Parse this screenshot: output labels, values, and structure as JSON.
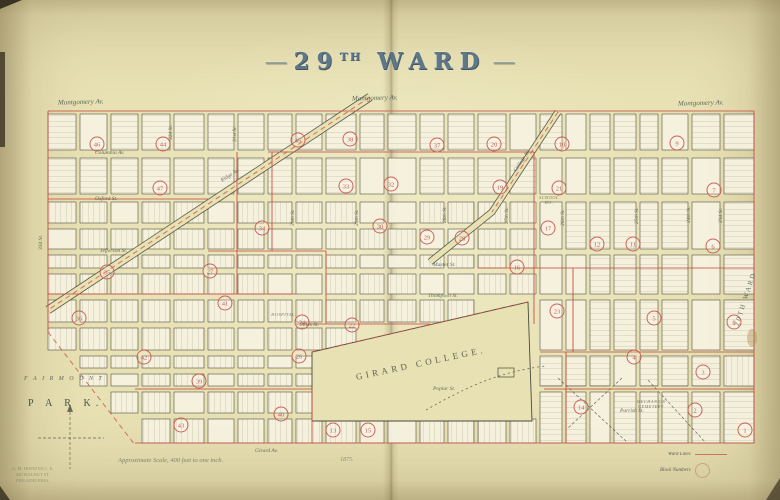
{
  "page": {
    "title_num": "29",
    "title_sup": "TH",
    "title_word": "WARD",
    "dash": "—"
  },
  "labels": {
    "montgomery": "Montgomery Av.",
    "fairmount": "F A I R M O U N T",
    "park": "P A R K.",
    "girard_college": "GIRARD  COLLEGE.",
    "side_ward": "20TH WARD",
    "scale_note": "Approximate Scale, 400 feet to one inch.",
    "date_note": "1875.",
    "legend_ward": "Ward Lines",
    "legend_block": "Block Numbers",
    "stamp": [
      "G. M. HOPKINS  C. E.",
      "320 WALNUT ST.",
      "PHILADELPHIA."
    ]
  },
  "colors": {
    "paper": "#e8e1b4",
    "block": "#f6f2df",
    "ink": "#4a4a3c",
    "red": "#c9544c",
    "faint_ink": "#80806c"
  },
  "map": {
    "bounds": {
      "x0": 48,
      "y0": 111,
      "x1": 754,
      "y1": 443
    },
    "sections": [
      {
        "cols": [
          [
            48,
            28
          ],
          [
            80,
            27
          ],
          [
            111,
            27
          ],
          [
            142,
            28
          ],
          [
            174,
            30
          ],
          [
            208,
            26
          ]
        ],
        "rows": [
          [
            114,
            36
          ],
          [
            158,
            36
          ],
          [
            202,
            21
          ],
          [
            229,
            20
          ],
          [
            255,
            13
          ],
          [
            274,
            20
          ],
          [
            300,
            22
          ],
          [
            328,
            22
          ],
          [
            356,
            12
          ],
          [
            374,
            12
          ],
          [
            392,
            21
          ],
          [
            419,
            24
          ]
        ]
      },
      {
        "cols": [
          [
            238,
            26
          ],
          [
            268,
            24
          ],
          [
            296,
            26
          ],
          [
            326,
            30
          ],
          [
            360,
            24
          ],
          [
            388,
            28
          ],
          [
            420,
            24
          ],
          [
            448,
            26
          ],
          [
            478,
            28
          ],
          [
            510,
            26
          ]
        ],
        "rows": [
          [
            114,
            36
          ],
          [
            158,
            36
          ],
          [
            202,
            21
          ],
          [
            229,
            20
          ],
          [
            255,
            13
          ],
          [
            274,
            20
          ],
          [
            300,
            22
          ],
          [
            328,
            22
          ],
          [
            356,
            12
          ],
          [
            374,
            12
          ],
          [
            392,
            21
          ],
          [
            419,
            24
          ]
        ]
      },
      {
        "cols": [
          [
            540,
            22
          ],
          [
            566,
            20
          ],
          [
            590,
            20
          ],
          [
            614,
            22
          ],
          [
            640,
            18
          ],
          [
            662,
            26
          ],
          [
            692,
            28
          ],
          [
            724,
            30
          ]
        ],
        "rows": [
          [
            114,
            36
          ],
          [
            158,
            36
          ],
          [
            202,
            47
          ],
          [
            255,
            39
          ],
          [
            300,
            50
          ],
          [
            356,
            30
          ],
          [
            392,
            51
          ]
        ]
      }
    ],
    "park": {
      "x1": 48,
      "y1": 332,
      "x2": 135,
      "y2": 445,
      "slope": 0.77
    },
    "college": {
      "poly": "312,352 528,302 532,421 312,421",
      "xmin": 314,
      "xmax": 536,
      "ytop": 352,
      "slope": 0.2315,
      "ybot": 424
    },
    "diagonals": [
      {
        "pts": "370,97 48,310",
        "w": 7
      },
      {
        "pts": "558,112 492,212 430,262",
        "w": 5.5
      }
    ],
    "extraLines": [
      [
        558,
        378,
        628,
        443
      ],
      [
        622,
        378,
        568,
        428
      ],
      [
        648,
        380,
        706,
        443
      ],
      [
        70,
        407,
        70,
        469
      ],
      [
        38,
        438,
        104,
        438
      ]
    ],
    "redLines": [
      [
        48,
        111,
        754,
        111
      ],
      [
        754,
        111,
        754,
        443
      ],
      [
        135,
        443,
        754,
        443
      ],
      [
        48,
        111,
        48,
        332
      ],
      [
        268,
        152,
        534,
        152
      ],
      [
        48,
        199,
        208,
        199
      ],
      [
        208,
        251,
        326,
        251
      ],
      [
        478,
        268,
        754,
        268
      ],
      [
        296,
        324,
        430,
        324
      ],
      [
        48,
        294,
        296,
        294
      ],
      [
        540,
        352,
        754,
        352
      ],
      [
        544,
        389,
        754,
        389
      ],
      [
        135,
        389,
        312,
        389
      ],
      [
        237,
        152,
        237,
        294
      ],
      [
        272,
        152,
        272,
        251
      ],
      [
        326,
        251,
        326,
        324
      ],
      [
        534,
        152,
        534,
        324
      ],
      [
        566,
        352,
        566,
        443
      ],
      [
        573,
        268,
        573,
        352
      ],
      [
        312,
        389,
        312,
        443
      ]
    ],
    "redDashes": [
      "370,97 48,310",
      "558,112 492,212",
      "48,332 135,445",
      "312,352 528,302"
    ],
    "curve": "M426,410 C470,385 500,372 545,366",
    "stain": {
      "x": 752,
      "y": 338,
      "rx": 5,
      "ry": 9
    },
    "circles": [
      [
        46,
        97,
        144
      ],
      [
        44,
        163,
        144
      ],
      [
        45,
        298,
        140
      ],
      [
        38,
        350,
        139
      ],
      [
        37,
        437,
        145
      ],
      [
        20,
        494,
        144
      ],
      [
        10,
        562,
        144
      ],
      [
        9,
        677,
        143
      ],
      [
        47,
        160,
        188
      ],
      [
        33,
        346,
        186
      ],
      [
        32,
        391,
        184
      ],
      [
        19,
        500,
        187
      ],
      [
        21,
        559,
        188
      ],
      [
        7,
        714,
        190
      ],
      [
        34,
        262,
        228
      ],
      [
        30,
        380,
        226
      ],
      [
        29,
        427,
        237
      ],
      [
        28,
        462,
        238
      ],
      [
        17,
        548,
        228
      ],
      [
        12,
        597,
        244
      ],
      [
        11,
        633,
        244
      ],
      [
        6,
        713,
        246
      ],
      [
        35,
        107,
        272
      ],
      [
        27,
        210,
        271
      ],
      [
        16,
        517,
        267
      ],
      [
        24,
        302,
        322
      ],
      [
        22,
        352,
        325
      ],
      [
        23,
        557,
        311
      ],
      [
        5,
        654,
        318
      ],
      [
        8,
        734,
        322
      ],
      [
        36,
        79,
        318
      ],
      [
        41,
        225,
        303
      ],
      [
        42,
        144,
        357
      ],
      [
        26,
        299,
        356
      ],
      [
        4,
        634,
        357
      ],
      [
        3,
        703,
        372
      ],
      [
        39,
        199,
        381
      ],
      [
        43,
        181,
        425
      ],
      [
        40,
        281,
        414
      ],
      [
        13,
        333,
        430
      ],
      [
        15,
        368,
        430
      ],
      [
        14,
        581,
        407
      ],
      [
        2,
        695,
        410
      ],
      [
        1,
        745,
        430
      ]
    ],
    "streetLabels": [
      [
        "Columbia Av.",
        95,
        154,
        0
      ],
      [
        "Oxford St.",
        95,
        200,
        0
      ],
      [
        "Jefferson St.",
        100,
        252,
        0
      ],
      [
        "Master St.",
        433,
        266,
        0
      ],
      [
        "Thompson St.",
        428,
        297,
        0
      ],
      [
        "Stiles St.",
        300,
        326,
        0
      ],
      [
        "Poplar St.",
        433,
        390,
        0
      ],
      [
        "Parrish St.",
        620,
        412,
        0
      ],
      [
        "Girard Av.",
        255,
        452,
        0
      ],
      [
        "Ridge Av.",
        222,
        182,
        -33
      ],
      [
        "College Av.",
        516,
        172,
        -56
      ],
      [
        "32d St.",
        172,
        140,
        -90
      ],
      [
        "31st St.",
        236,
        142,
        -90
      ],
      [
        "30th St.",
        294,
        226,
        -90
      ],
      [
        "29th St.",
        358,
        226,
        -90
      ],
      [
        "28th St.",
        446,
        223,
        -90
      ],
      [
        "27th St.",
        508,
        224,
        -90
      ],
      [
        "26th St.",
        564,
        226,
        -90
      ],
      [
        "25th St.",
        638,
        224,
        -90
      ],
      [
        "24th St.",
        690,
        223,
        -90
      ],
      [
        "23d St.",
        722,
        223,
        -90
      ],
      [
        "33d St.",
        42,
        250,
        -90
      ]
    ],
    "blockLabels": [
      {
        "t": [
          "SCHOOL",
          "HO."
        ],
        "x": 549,
        "y": 199
      },
      {
        "t": [
          "MECHANICS",
          "CEMETERY"
        ],
        "x": 651,
        "y": 403
      },
      {
        "t": [
          "HOSPITAL"
        ],
        "x": 283,
        "y": 316
      }
    ]
  }
}
